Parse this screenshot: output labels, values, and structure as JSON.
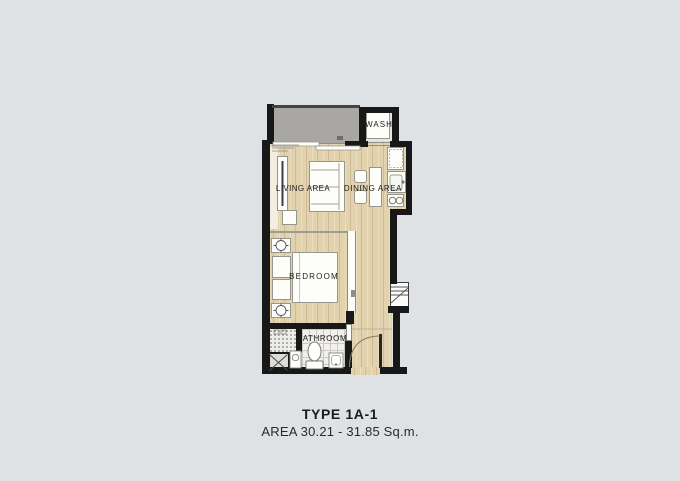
{
  "plan": {
    "title": "TYPE 1A-1",
    "area_text": "AREA 30.21 - 31.85 Sq.m.",
    "rooms": {
      "wash": "WASH",
      "living": "LIVING AREA",
      "dining": "DINING AREA",
      "bedroom": "BEDROOM",
      "bathroom": "BATHROOM"
    },
    "colors": {
      "wall": "#181818",
      "floor-wood": "#e2d2ae",
      "balcony": "#a8a7a3",
      "tile": "#f1f0ec",
      "furniture": "#fdfdfa",
      "background": "#dfe2e4",
      "text": "#1d1d1d"
    }
  }
}
